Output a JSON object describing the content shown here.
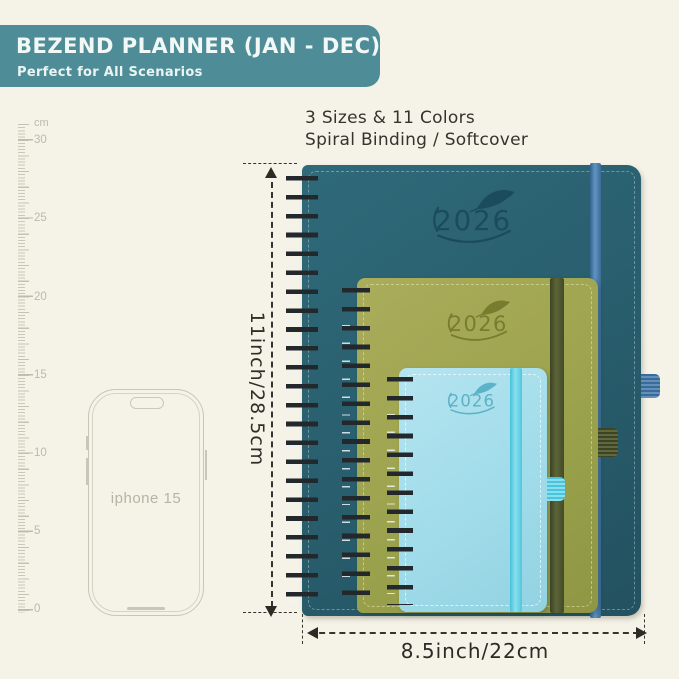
{
  "banner": {
    "title": "BEZEND PLANNER (JAN - DEC)",
    "subtitle": "Perfect for All Scenarios",
    "bg_color": "#4e8d98"
  },
  "headline": {
    "line1": "3 Sizes & 11 Colors",
    "line2": "Spiral Binding / Softcover"
  },
  "ruler": {
    "unit": "cm",
    "labels": [
      "30",
      "25",
      "20",
      "15",
      "10",
      "5",
      "0"
    ]
  },
  "phone": {
    "label": "iphone 15"
  },
  "planners": {
    "large": {
      "year": "2026",
      "cover_color": "#2a616f",
      "band_color": "#4b80ae"
    },
    "medium": {
      "year": "2026",
      "cover_color": "#9da14f",
      "band_color": "#4c5430"
    },
    "small": {
      "year": "2026",
      "cover_color": "#a0dce9",
      "band_color": "#5fd0e4"
    }
  },
  "dimensions": {
    "height_label": "11inch/28.5cm",
    "width_label": "8.5inch/22cm"
  },
  "page_bg_color": "#f5f2e7"
}
